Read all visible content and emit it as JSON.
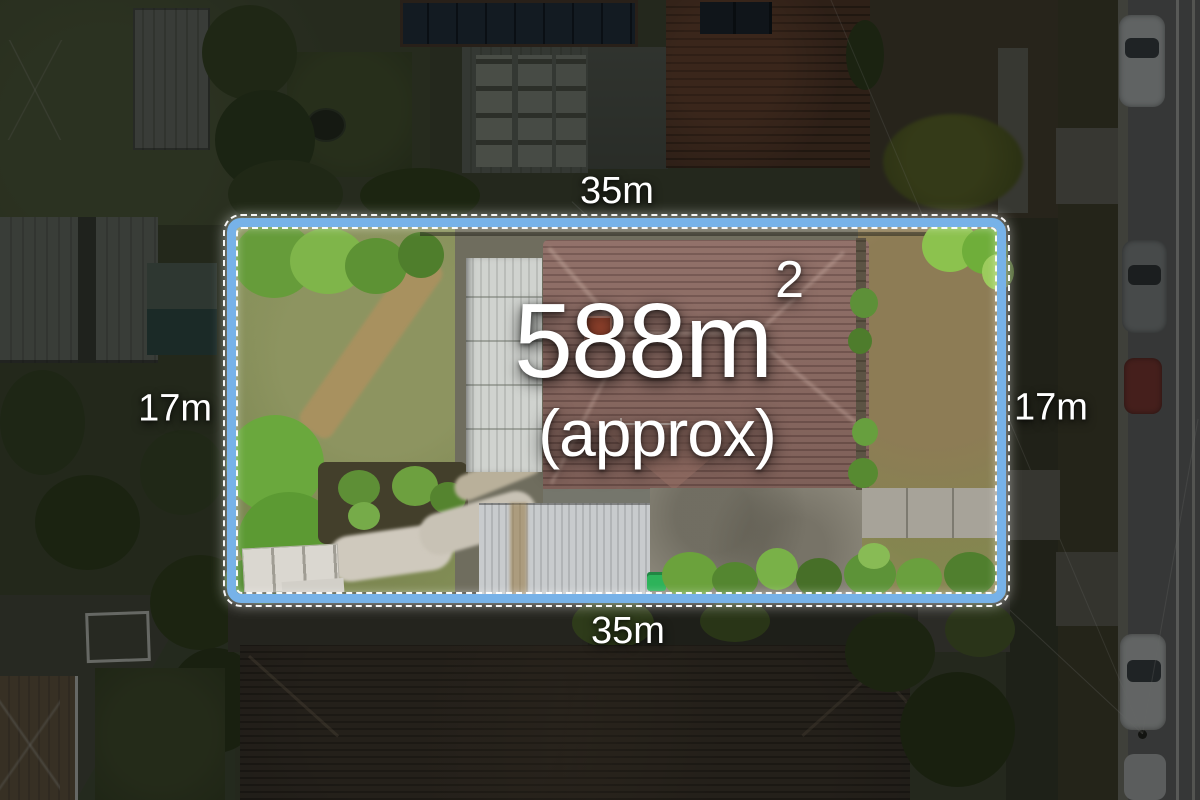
{
  "image": {
    "type": "aerial-property-photo",
    "description": "Top-down drone photograph of a suburban lot with a highlighted boundary and land-size overlay"
  },
  "overlay": {
    "boundary": {
      "stroke_color": "#77b2e8",
      "dash_color": "#ffffff"
    },
    "text_color": "#ffffff",
    "labels": {
      "area": "588m",
      "area_sup": "2",
      "approx": "(approx)",
      "top_width": "35m",
      "bottom_width": "35m",
      "left_depth": "17m",
      "right_depth": "17m"
    }
  }
}
